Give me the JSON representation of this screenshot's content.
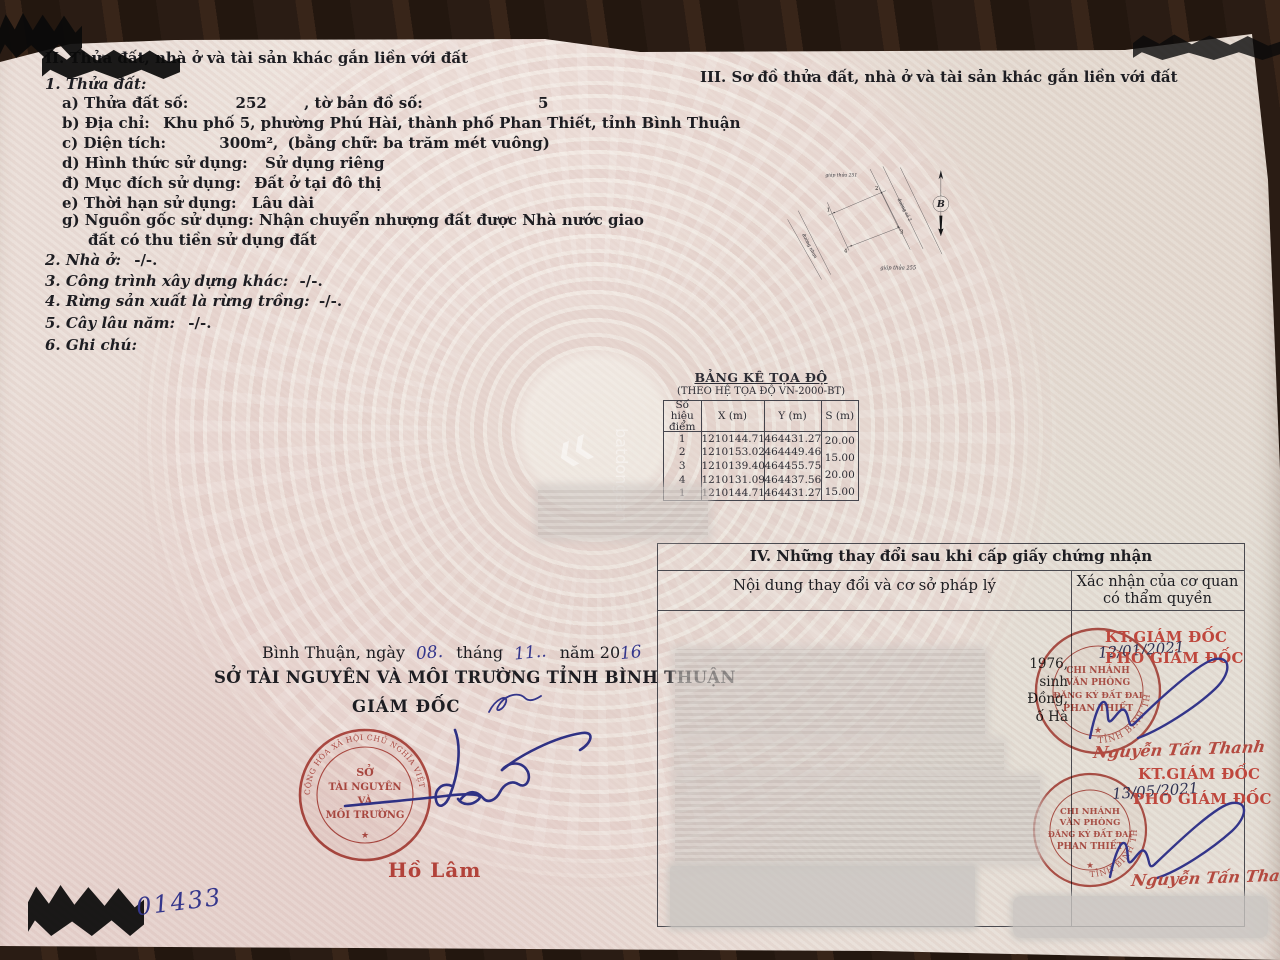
{
  "section2": {
    "heading": "II. Thửa đất, nhà ở và tài sản khác gắn liền với đất",
    "sub1": "1. Thửa đất:",
    "a_label": "a) Thửa đất số:",
    "a_value": "252",
    "a_label2": ", tờ bản đồ số:",
    "a_value2": "5",
    "b_label": "b) Địa chỉ:",
    "b_value": "Khu phố 5, phường Phú Hài, thành phố Phan Thiết, tỉnh Bình Thuận",
    "c_label": "c) Diện tích:",
    "c_value": "300m²,",
    "c_value2": "(bằng chữ: ba trăm mét vuông)",
    "d_label": "d) Hình thức sử dụng:",
    "d_value": "Sử dụng riêng",
    "dd_label": "đ) Mục đích sử dụng:",
    "dd_value": "Đất ở tại đô thị",
    "e_label": "e) Thời hạn sử dụng:",
    "e_value": "Lâu dài",
    "g_label": "g) Nguồn gốc sử dụng:",
    "g_value": "Nhận chuyển nhượng đất được Nhà nước giao đất có thu tiền sử dụng đất",
    "other_items": [
      {
        "label": "2. Nhà ở:",
        "value": "-/-."
      },
      {
        "label": "3. Công trình xây dựng khác:",
        "value": "-/-."
      },
      {
        "label": "4. Rừng sản xuất là rừng trồng:",
        "value": "-/-."
      },
      {
        "label": "5. Cây lâu năm:",
        "value": "-/-."
      },
      {
        "label": "6. Ghi chú:",
        "value": ""
      }
    ]
  },
  "section3": {
    "heading": "III. Sơ đồ thửa đất, nhà ở và tài sản khác gắn liền với đất",
    "adjacent_top": "giáp thửa 251",
    "adjacent_bottom": "giáp thửa 255",
    "road_right": "đường số 2",
    "road_left": "đường nhựa",
    "point1": "1",
    "point2": "2",
    "point3": "3",
    "point4": "4",
    "compass": "B"
  },
  "coord_table": {
    "title": "BẢNG KÊ TỌA ĐỘ",
    "subtitle": "(THEO HỆ TỌA ĐỘ VN-2000-BT)",
    "h_point": "Số hiệu điểm",
    "h_x": "X (m)",
    "h_y": "Y (m)",
    "h_s": "S (m)",
    "rows": [
      {
        "p": "1",
        "x": "1210144.71",
        "y": "464431.27"
      },
      {
        "p": "2",
        "x": "1210153.02",
        "y": "464449.46"
      },
      {
        "p": "3",
        "x": "1210139.40",
        "y": "464455.75"
      },
      {
        "p": "4",
        "x": "1210131.09",
        "y": "464437.56"
      },
      {
        "p": "1",
        "x": "1210144.71",
        "y": "464431.27"
      }
    ],
    "s_values": [
      "20.00",
      "15.00",
      "20.00",
      "15.00"
    ]
  },
  "section4": {
    "heading": "IV. Những thay đổi sau khi cấp giấy chứng nhận",
    "col1": "Nội dung thay đổi và cơ sở pháp lý",
    "col2a": "Xác nhận của cơ quan",
    "col2b": "có thẩm quyền",
    "fragments": [
      "1976,",
      "sinh",
      "Đồng,",
      "ố Hà"
    ],
    "entry1": {
      "kt": "KT.GIÁM ĐỐC",
      "date": "12/01/2021",
      "pho": "PHÓ GIÁM ĐỐC",
      "name": "Nguyễn Tấn Thanh"
    },
    "entry2": {
      "kt": "KT.GIÁM ĐỐC",
      "date": "13/05/2021",
      "pho": "PHÓ GIÁM ĐỐC",
      "name": "Nguyễn Tấn Thanh"
    },
    "branch_stamp": {
      "l1": "CHI NHÁNH",
      "l2": "VĂN PHÒNG",
      "l3": "ĐĂNG KÝ ĐẤT ĐAI",
      "l4": "PHAN THIẾT",
      "ring": "TỈNH BÌNH THUẬN"
    }
  },
  "issuer": {
    "date_prefix": "Bình Thuận, ngày",
    "date_day": "08.",
    "date_thang": "tháng",
    "date_month": "11..",
    "date_nam": "năm 20",
    "date_year": "16",
    "agency": "SỞ TÀI NGUYÊN VÀ MÔI TRƯỜNG TỈNH BÌNH THUẬN",
    "title": "GIÁM ĐỐC",
    "signer": "Hồ Lâm",
    "stamp": {
      "l1": "SỞ",
      "l2": "TÀI NGUYÊN",
      "l3": "VÀ",
      "l4": "MÔI TRƯỜNG",
      "ring": "CỘNG HÒA XÃ HỘI CHỦ NGHĨA VIỆT NAM",
      "star": "★"
    }
  },
  "serial": {
    "visible": "01433"
  },
  "watermark": {
    "chevrons": "❮❮",
    "text": "batdongsan"
  },
  "colors": {
    "stamp_red": "#b2423a",
    "ink_blue": "#34368c",
    "paper": "#e9ddd6",
    "background": "#281c14"
  }
}
